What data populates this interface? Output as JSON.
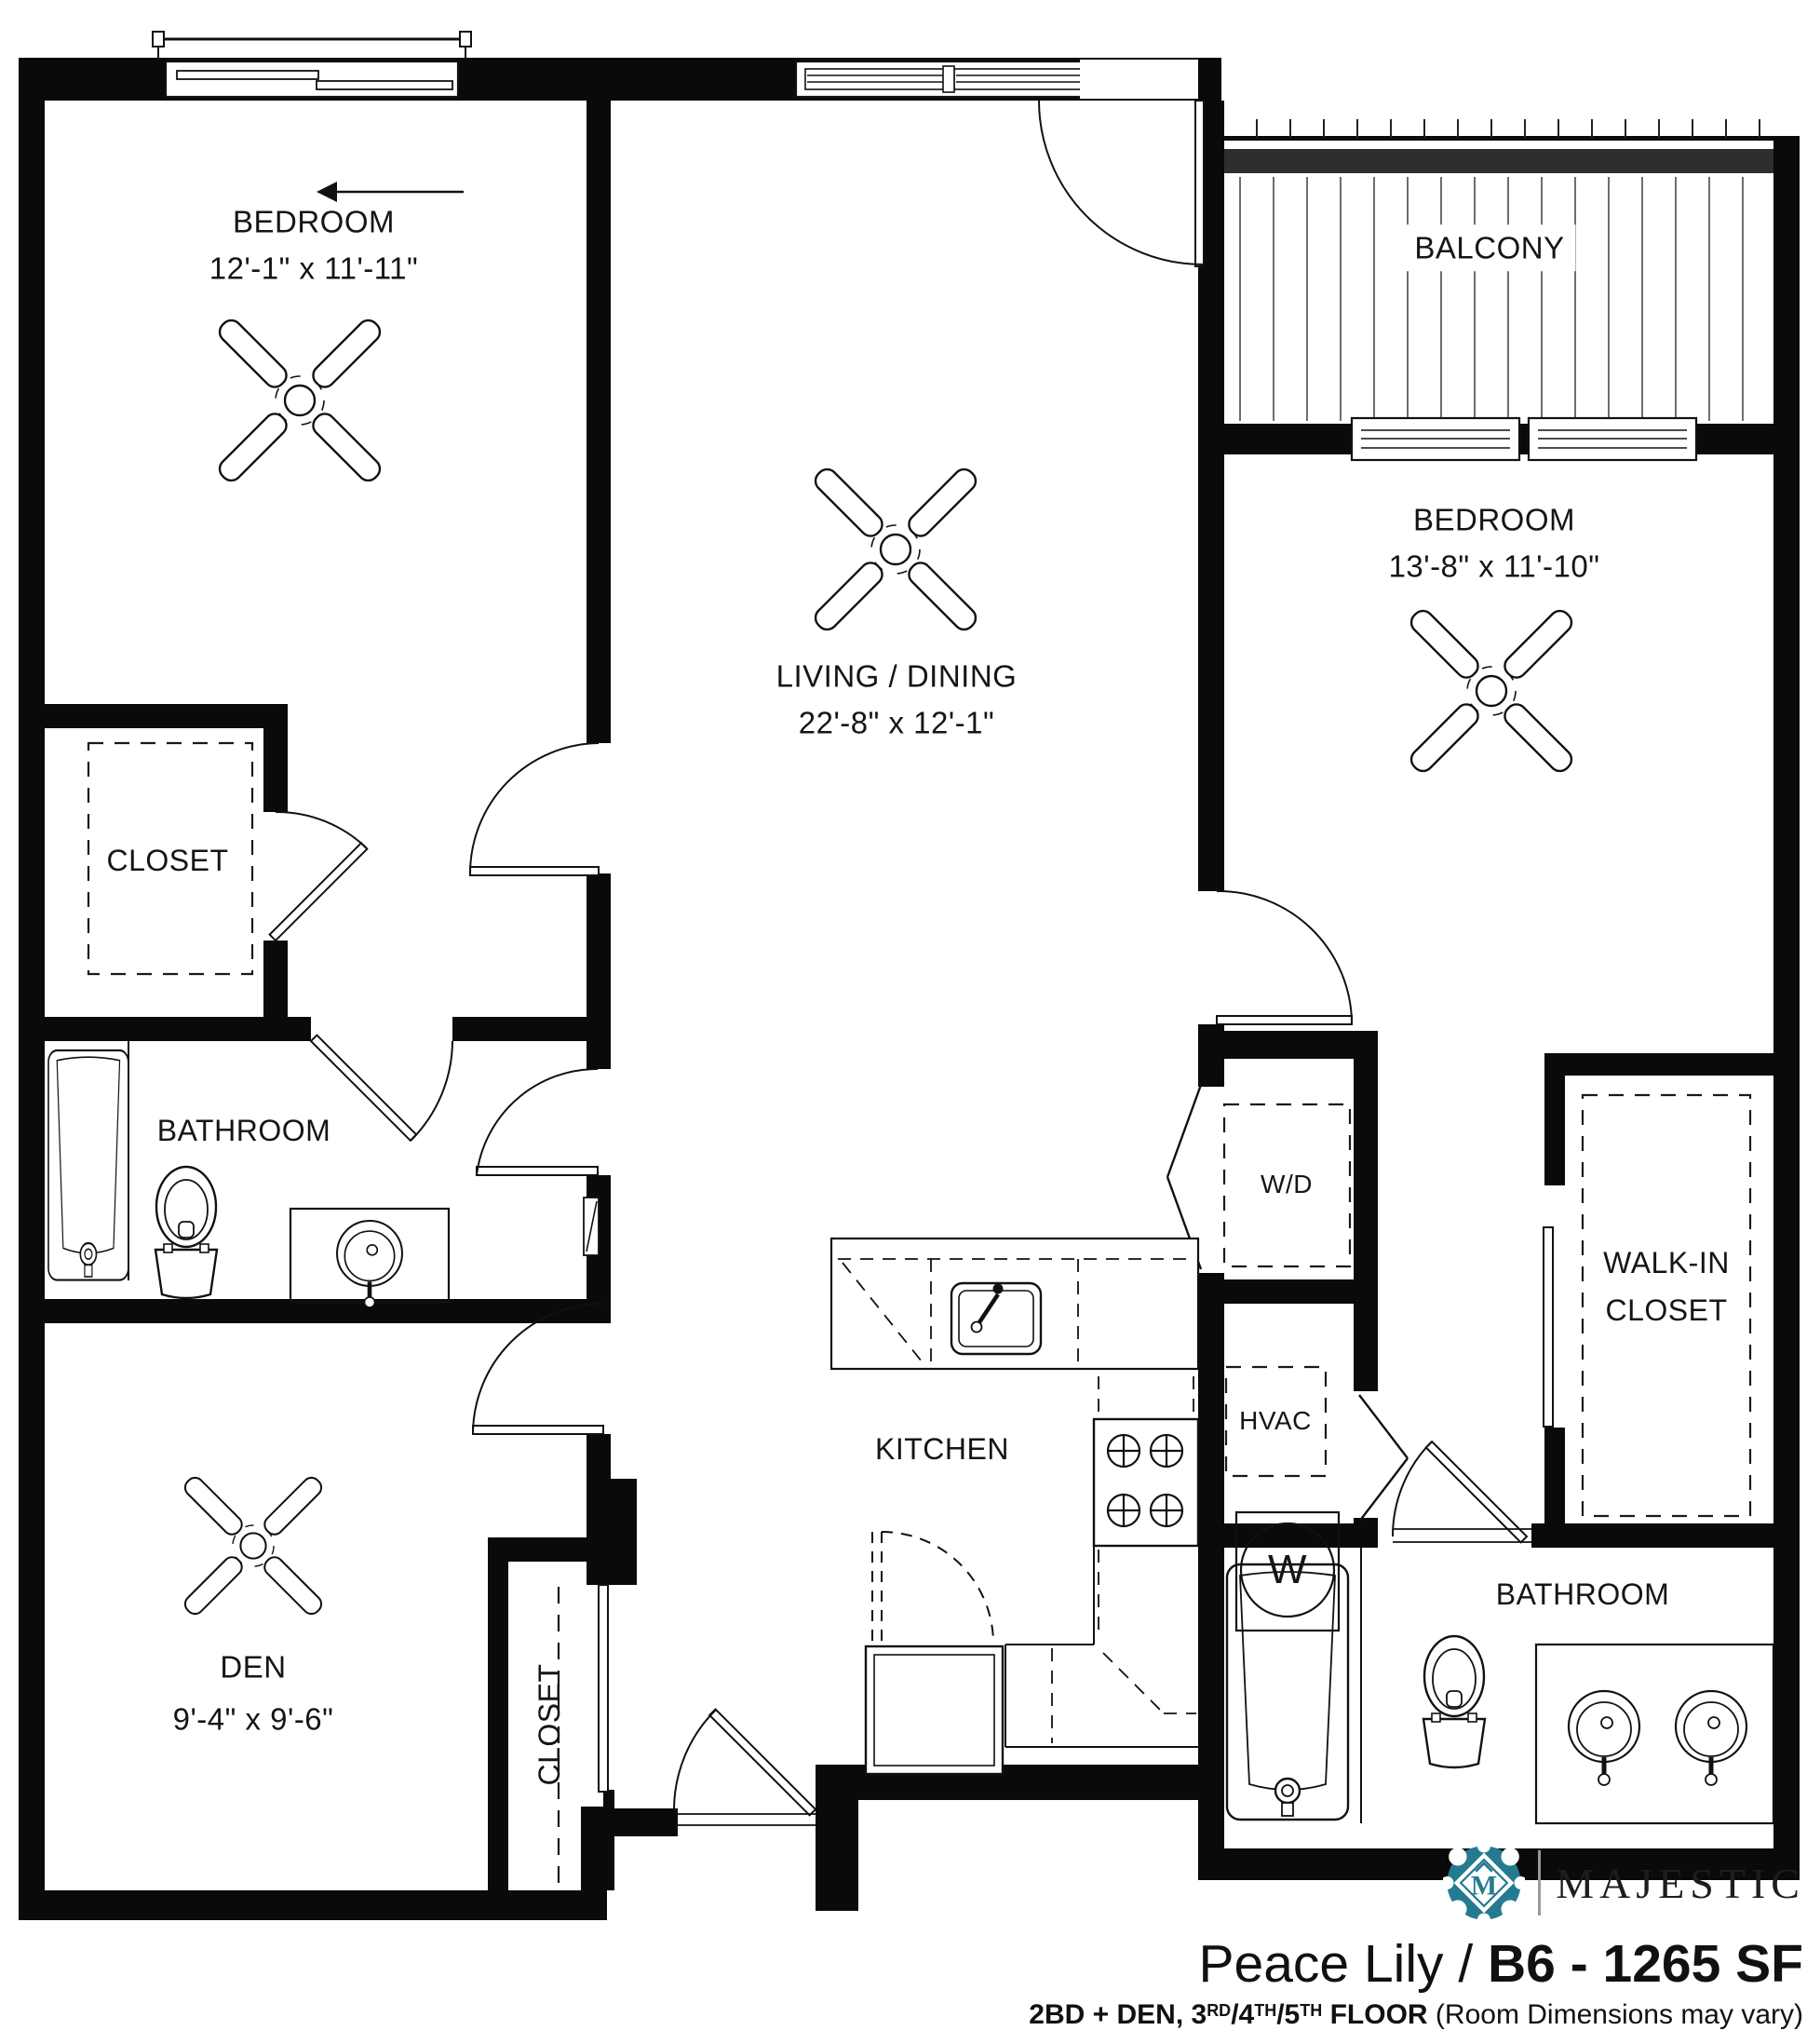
{
  "plan": {
    "rooms": {
      "bedroom1": {
        "name": "BEDROOM",
        "dims": "12'-1\" x 11'-11\""
      },
      "living": {
        "name": "LIVING / DINING",
        "dims": "22'-8\" x 12'-1\""
      },
      "bedroom2": {
        "name": "BEDROOM",
        "dims": "13'-8\" x 11'-10\""
      },
      "den": {
        "name": "DEN",
        "dims": "9'-4\" x 9'-6\""
      },
      "balcony": {
        "name": "BALCONY"
      },
      "closet_bedroom1": {
        "name": "CLOSET"
      },
      "closet_den": {
        "name": "CLOSET"
      },
      "bathroom1": {
        "name": "BATHROOM"
      },
      "bathroom2": {
        "name": "BATHROOM"
      },
      "walk_in_closet": {
        "line1": "WALK-IN",
        "line2": "CLOSET"
      },
      "kitchen": {
        "name": "KITCHEN"
      },
      "washer_dryer": {
        "name": "W/D"
      },
      "hvac": {
        "name": "HVAC"
      },
      "water_heater": {
        "name": "W"
      }
    },
    "colors": {
      "wall": "#0a0a0a",
      "logo_teal": "#247b90"
    }
  },
  "branding": {
    "logo_monogram": "M",
    "brand": "MAJESTIC",
    "title_regular": "Peace Lily / ",
    "title_bold": "B6 - 1265 SF",
    "subtitle": {
      "p1": "2BD + DEN, 3",
      "p2": "RD",
      "p3": "/4",
      "p4": "TH",
      "p5": "/5",
      "p6": "TH",
      "p7": " FLOOR",
      "p8": " (Room Dimensions may vary)"
    }
  }
}
